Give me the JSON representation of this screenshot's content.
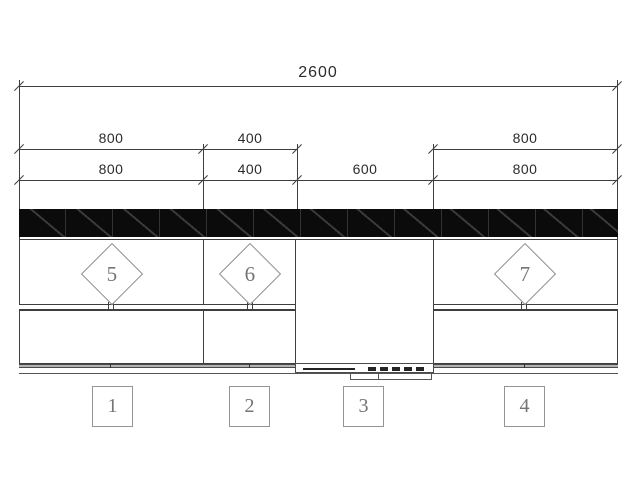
{
  "drawing": {
    "overall_dimension": "2600",
    "dim_row_upper": [
      "800",
      "400",
      "800"
    ],
    "dim_row_lower": [
      "800",
      "400",
      "600",
      "800"
    ],
    "cabinet_markers": [
      "5",
      "6",
      "7"
    ],
    "position_markers": [
      "1",
      "2",
      "3",
      "4"
    ],
    "colors": {
      "line": "#3e3e3e",
      "light": "#8d8d8d",
      "band": "#0b0b0b",
      "hatch": "#3a3a3a",
      "toe": "#b3b3b3",
      "text": "#2c2c2c",
      "marker": "#757575",
      "dark": "#242424"
    }
  }
}
